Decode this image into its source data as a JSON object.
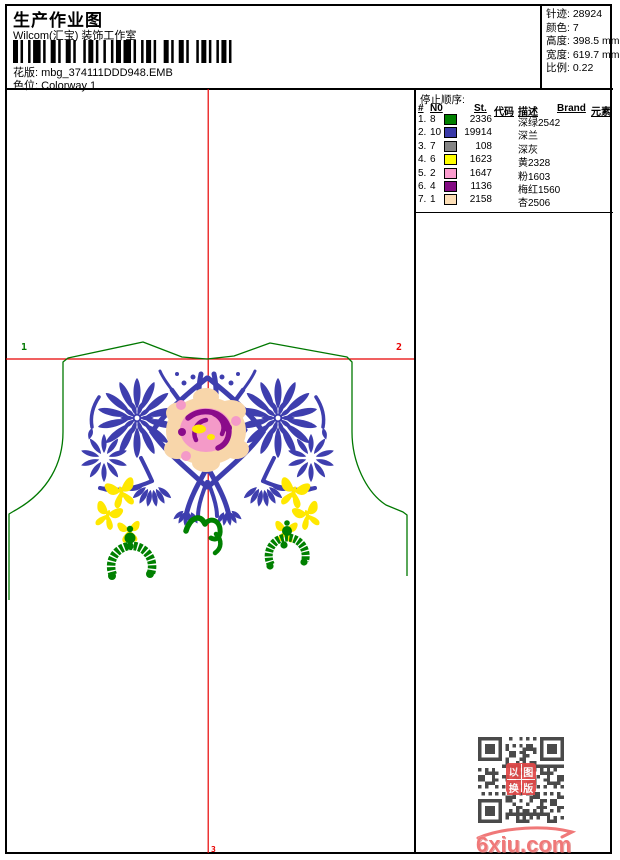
{
  "header": {
    "title": "生产作业图",
    "subtitle": "Wilcom(汇宝) 装饰工作室",
    "pattern_label": "花版:",
    "pattern_value": "mbg_374111DDD948.EMB",
    "colorway_label": "色位:",
    "colorway_value": "Colorway 1"
  },
  "info_box": {
    "rows": [
      {
        "label": "针迹:",
        "value": "28924"
      },
      {
        "label": "颜色:",
        "value": "7"
      },
      {
        "label": "高度:",
        "value": "398.5 mm"
      },
      {
        "label": "宽度:",
        "value": "619.7 mm"
      },
      {
        "label": "比例:",
        "value": "0.22"
      }
    ]
  },
  "stop_sequence": {
    "title": "停止顺序:",
    "columns": [
      "#",
      "N0",
      "St.",
      "代码",
      "描述",
      "Brand",
      "元素"
    ],
    "rows": [
      {
        "order": "1.",
        "needle": "8",
        "color": "#008000",
        "stitches": "2336",
        "description": "深绿2542"
      },
      {
        "order": "2.",
        "needle": "10",
        "color": "#3939a8",
        "stitches": "19914",
        "description": "深兰"
      },
      {
        "order": "3.",
        "needle": "7",
        "color": "#848484",
        "stitches": "108",
        "description": "深灰"
      },
      {
        "order": "4.",
        "needle": "6",
        "color": "#ffff00",
        "stitches": "1623",
        "description": "黄2328"
      },
      {
        "order": "5.",
        "needle": "2",
        "color": "#fb9cce",
        "stitches": "1647",
        "description": "粉1603"
      },
      {
        "order": "6.",
        "needle": "4",
        "color": "#830b83",
        "stitches": "1136",
        "description": "梅红1560"
      },
      {
        "order": "7.",
        "needle": "1",
        "color": "#fcdeb6",
        "stitches": "2158",
        "description": "杏2506"
      }
    ]
  },
  "canvas": {
    "markers": {
      "left": "1",
      "right": "2",
      "bottom": "3"
    }
  },
  "watermark": {
    "site": "6xiu.com",
    "stamp_chars": [
      "以",
      "图",
      "换",
      "版"
    ]
  },
  "colors": {
    "redline": "#e80000",
    "garment": "#007800",
    "blue": "#3e3eae",
    "green": "#008000",
    "yellow": "#ffe800",
    "pink": "#f49ac8",
    "magenta": "#8a0b8a",
    "peach": "#f8d6aa",
    "qr": "#4a4a4a",
    "stamp": "#e04848",
    "watermark": "#f07878"
  }
}
